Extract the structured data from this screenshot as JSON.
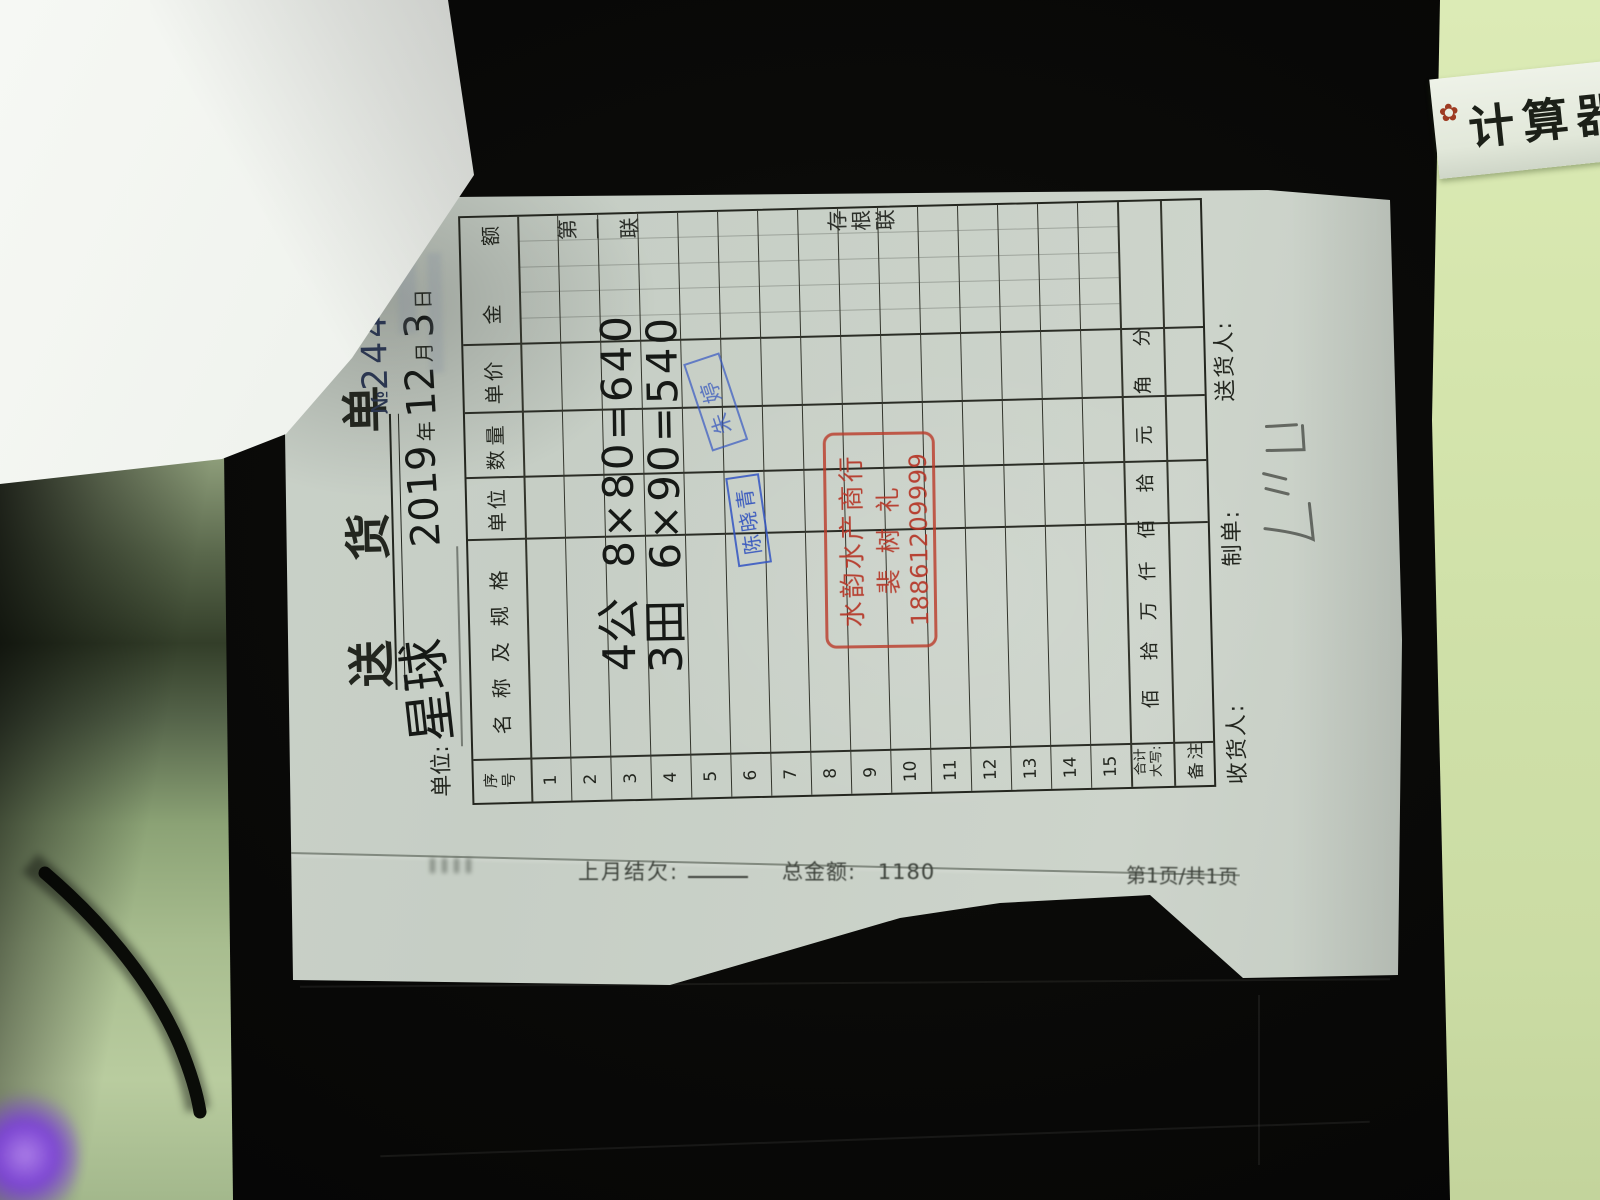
{
  "scene": {
    "background": "dark desk in low light",
    "calculator_label": "计算器",
    "flower_icon": "✿",
    "colors": {
      "device_green": "#cfe0a8",
      "table_green": "#a8bd8f",
      "paper": "#c9d0c7",
      "led_purple": "#7a3bdc",
      "stamp_red": "#b5392a",
      "stamp_blue": "#2f55c2",
      "ink": "#161916",
      "serial_blue": "#2b3650"
    }
  },
  "lower_sheet": {
    "prev_balance_label": "上月结欠:",
    "total_label": "总金额:",
    "total_value": "1180",
    "page_indicator": "第1页/共1页"
  },
  "note": {
    "title": "送 货 单",
    "serial_prefix": "№",
    "serial_number": "2443",
    "unit_label": "单位:",
    "unit_value_handwritten": "星球",
    "date": {
      "year": "2019",
      "year_label": "年",
      "month": "12",
      "month_label": "月",
      "day": "3",
      "day_label": "日"
    },
    "copy_label_top": "第一联",
    "copy_label_bottom": "存根联",
    "table": {
      "headers": {
        "no": "序号",
        "no_char1": "序",
        "no_char2": "号",
        "name": "名称及规格",
        "unit": "单位",
        "qty": "数量",
        "price": "单价",
        "amount": "金  额"
      },
      "rows": [
        {
          "no": "1",
          "text": ""
        },
        {
          "no": "2",
          "text": ""
        },
        {
          "no": "3",
          "text": "4公 8×80=640",
          "item": "4公",
          "calc": "8×80=640"
        },
        {
          "no": "4",
          "text": "3田 6×90=540",
          "item": "3田",
          "calc": "6×90=540"
        },
        {
          "no": "5",
          "text": ""
        },
        {
          "no": "6",
          "text": ""
        },
        {
          "no": "7",
          "text": ""
        },
        {
          "no": "8",
          "text": ""
        },
        {
          "no": "9",
          "text": ""
        },
        {
          "no": "10",
          "text": ""
        },
        {
          "no": "11",
          "text": ""
        },
        {
          "no": "12",
          "text": ""
        },
        {
          "no": "13",
          "text": ""
        },
        {
          "no": "14",
          "text": ""
        },
        {
          "no": "15",
          "text": ""
        }
      ],
      "total_label_line1": "合计",
      "total_label_line2": "大写:",
      "digit_columns": [
        "佰",
        "拾",
        "万",
        "仟",
        "佰",
        "拾",
        "元",
        "角",
        "分"
      ],
      "currency_symbol": "¥",
      "total_amount_handwritten": "1180",
      "tick_mark": "ˊ",
      "remark_label": "备注"
    },
    "stamps": {
      "red": {
        "line1": "水韵水产商行",
        "line2": "裴树礼",
        "line3": "18861209999",
        "color": "#b5392a"
      },
      "blue_name": {
        "text": "陈晓青",
        "color": "#2f55c2"
      },
      "blue_name_2": {
        "text": "朱婷",
        "color": "#2f55c2"
      }
    },
    "footer": {
      "receiver_label": "收货人:",
      "maker_label": "制单:",
      "deliverer_label": "送货人:"
    }
  }
}
